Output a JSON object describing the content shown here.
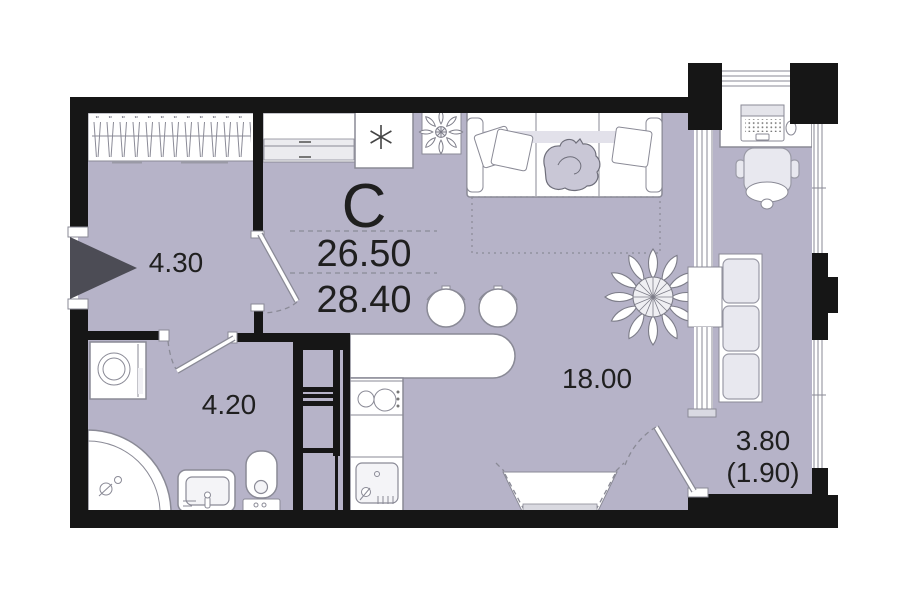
{
  "plan": {
    "unit_type_label": "C",
    "total_area": "26.50",
    "area_with_balcony": "28.40",
    "rooms": {
      "hall": "4.30",
      "bathroom": "4.20",
      "living_kitchen": "18.00",
      "balcony": "3.80",
      "balcony_reduced": "(1.90)"
    },
    "colors": {
      "floor": "#b6b3c8",
      "walls": "#161616",
      "outline": "#8a8a96",
      "entry_arrow": "#4c4c55",
      "label_text": "#1f1f1f"
    }
  }
}
